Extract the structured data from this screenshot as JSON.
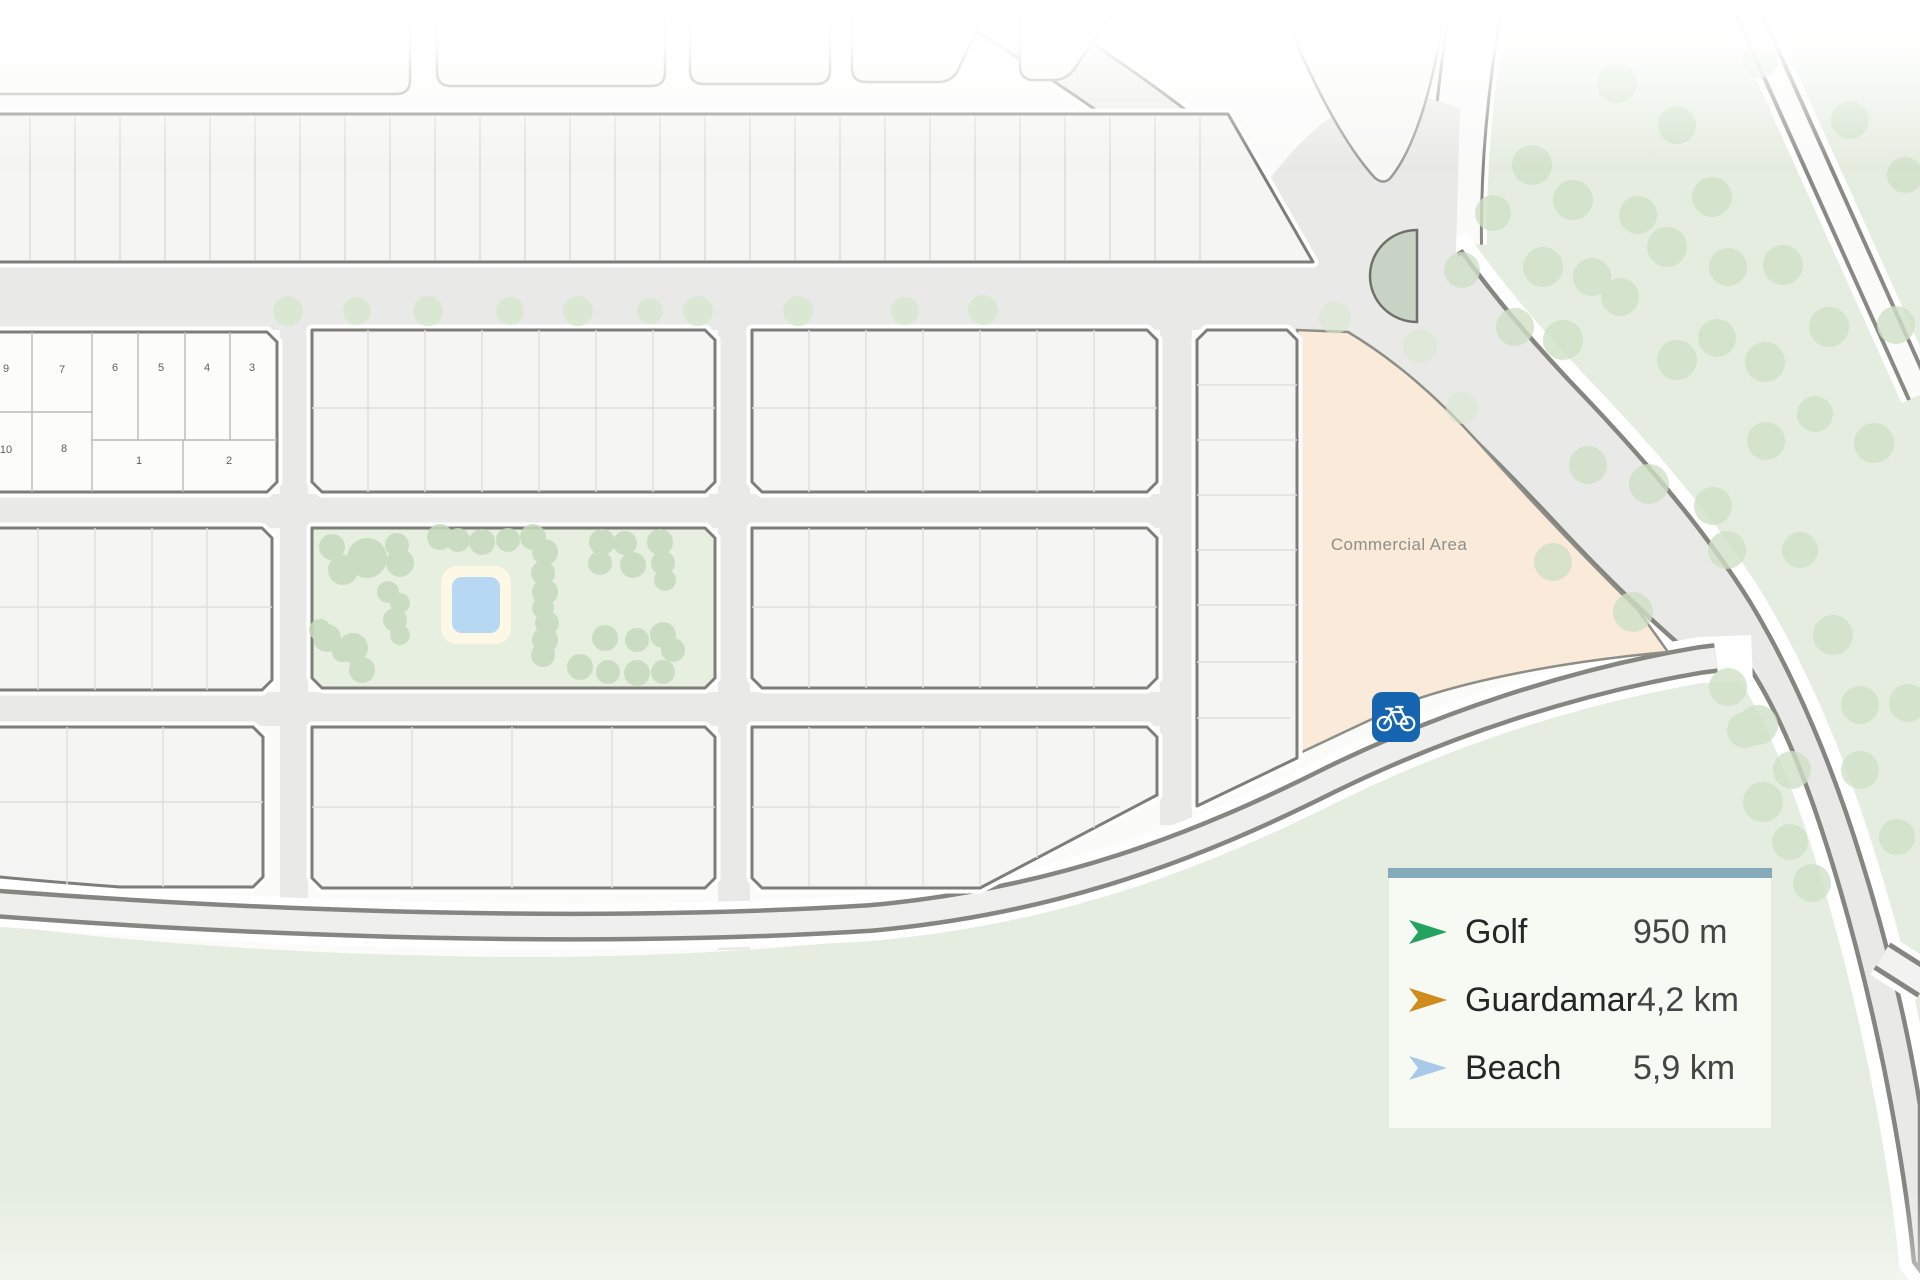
{
  "map": {
    "commercial_area_label": "Commercial Area",
    "plot_numbers": [
      "9",
      "7",
      "6",
      "5",
      "4",
      "3",
      "10",
      "8",
      "1",
      "2"
    ],
    "features": {
      "bike_sign_icon": "bicycle-sign",
      "roundabout_island": "green semicircle traffic island",
      "park": "central park block with pool",
      "forest": "tree area right side"
    },
    "colors": {
      "road_fill": "#e9e9e7",
      "road_edge": "#85867f",
      "block_fill": "#f5f5f3",
      "block_outline": "#7d7e78",
      "green_base": "#e5ede0",
      "park_green": "#e7efe1",
      "tree_dot": "#cfe0c7",
      "island_green": "#c9d3c5",
      "commercial_fill": "#faead9",
      "pool_blue": "#b7d8f3",
      "pool_deck": "#fdf7e6",
      "bike_sign_blue": "#1565b0"
    }
  },
  "legend": {
    "accent_bar_color": "#84aabc",
    "items": [
      {
        "label": "Golf",
        "distance": "950 m",
        "color": "#22a45e",
        "icon": "arrow-marker-green"
      },
      {
        "label": "Guardamar",
        "distance": "4,2 km",
        "color": "#cf8b1c",
        "icon": "arrow-marker-orange"
      },
      {
        "label": "Beach",
        "distance": "5,9 km",
        "color": "#a9c9e8",
        "icon": "arrow-marker-lightblue"
      }
    ]
  }
}
